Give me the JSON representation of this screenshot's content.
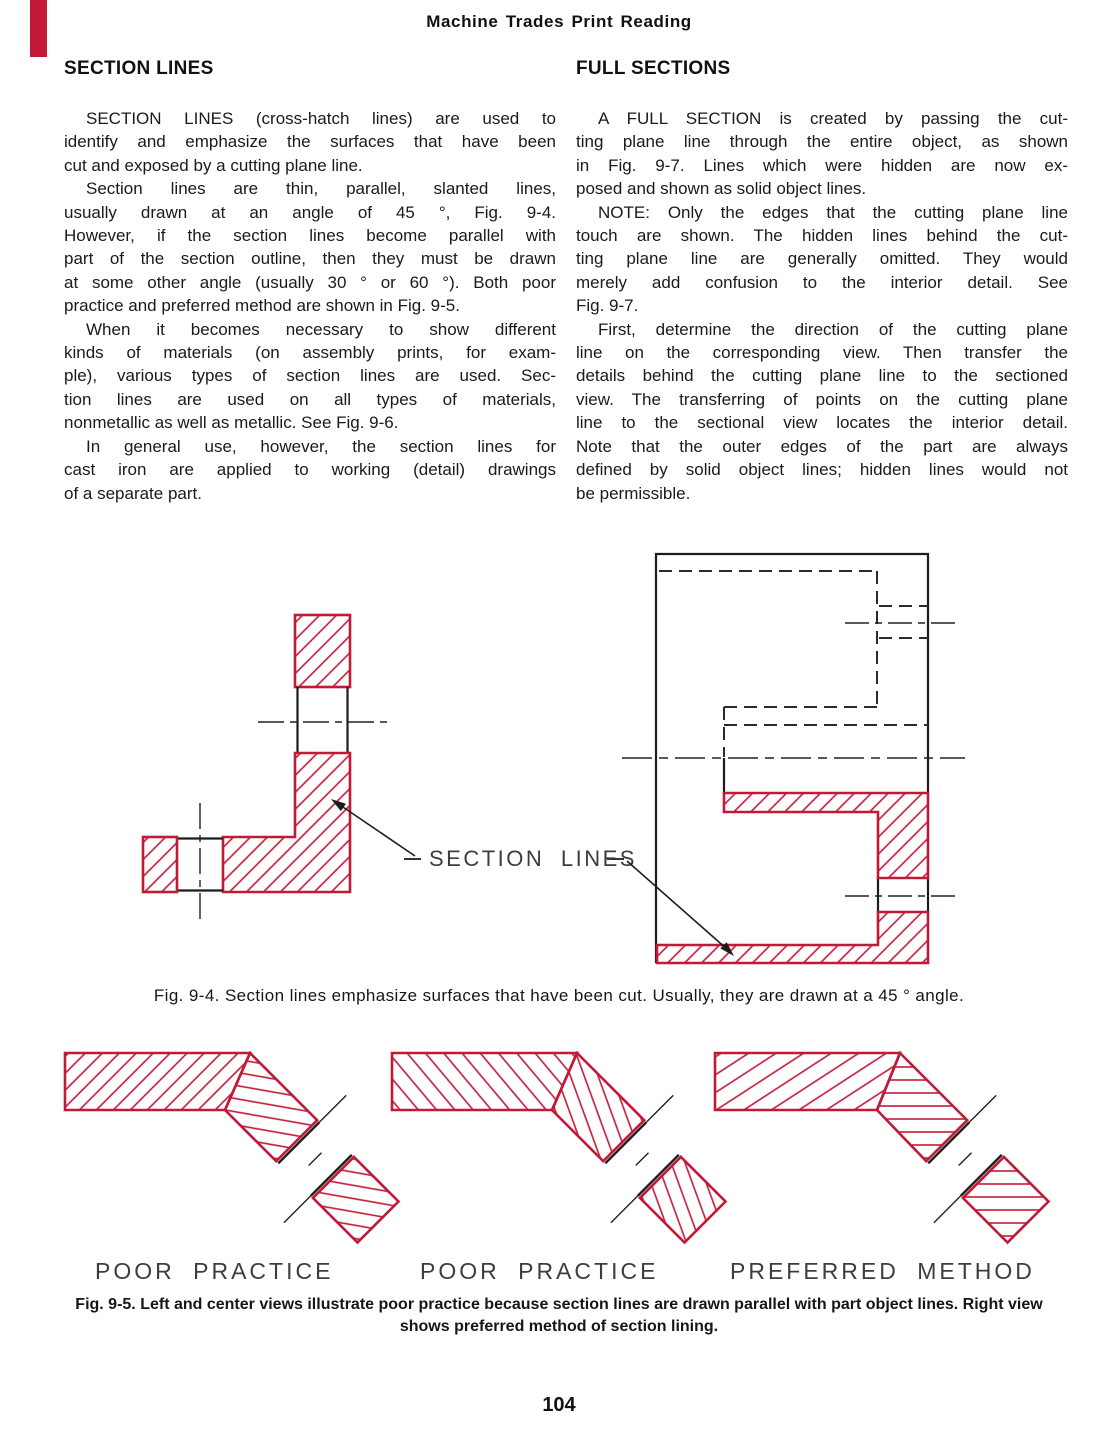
{
  "page": {
    "header": "Machine Trades Print Reading",
    "page_number": "104",
    "accent_red": "#c21937"
  },
  "columns": {
    "left": {
      "heading": "SECTION LINES",
      "paragraphs": [
        [
          "SECTION LINES (cross-hatch lines) are used to",
          "identify and emphasize the surfaces that have been",
          "cut and exposed by a cutting plane line."
        ],
        [
          "Section lines are thin, parallel, slanted lines,",
          "usually drawn at an angle of 45 °, Fig. 9-4.",
          "However, if the section lines become parallel with",
          "part of the section outline, then they must be drawn",
          "at some other angle (usually 30 ° or 60 °). Both poor",
          "practice and preferred method are shown in Fig. 9-5."
        ],
        [
          "When it becomes necessary to show different",
          "kinds of materials (on assembly prints, for exam-",
          "ple), various types of section lines are used. Sec-",
          "tion lines are used on all types of materials,",
          "nonmetallic as well as metallic. See Fig. 9-6."
        ],
        [
          "In general use, however, the section lines for",
          "cast iron are applied to working (detail) drawings",
          "of a separate part."
        ]
      ]
    },
    "right": {
      "heading": "FULL SECTIONS",
      "paragraphs": [
        [
          "A FULL SECTION is created by passing the cut-",
          "ting plane line through the entire object, as shown",
          "in Fig. 9-7. Lines which were hidden are now ex-",
          "posed and shown as solid object lines."
        ],
        [
          "NOTE: Only the edges that the cutting plane line",
          "touch are shown. The hidden lines behind the cut-",
          "ting plane line are generally omitted. They would",
          "merely add confusion to the interior detail. See",
          "Fig. 9-7."
        ],
        [
          "First, determine the direction of the cutting plane",
          "line on the corresponding view. Then transfer the",
          "details behind the cutting plane line to the sectioned",
          "view. The transferring of points on the cutting plane",
          "line to the sectional view locates the interior detail.",
          "Note that the outer edges of the part are always",
          "defined by solid object lines; hidden lines would not",
          "be permissible."
        ]
      ]
    }
  },
  "fig94": {
    "label": "SECTION LINES",
    "caption": "Fig. 9-4. Section lines emphasize surfaces that have been cut. Usually, they are drawn at a 45 ° angle."
  },
  "fig95": {
    "labels": [
      "POOR PRACTICE",
      "POOR PRACTICE",
      "PREFERRED METHOD"
    ],
    "caption": "Fig. 9-5. Left and center views illustrate poor practice because section lines are drawn parallel with part object lines. Right view shows preferred method of section lining."
  }
}
